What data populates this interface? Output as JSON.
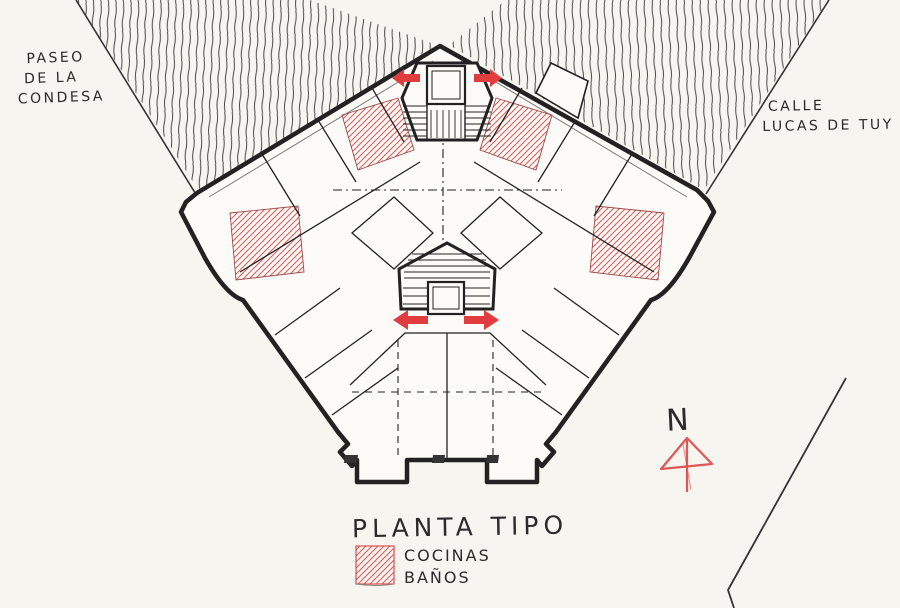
{
  "drawing": {
    "kind": "hand-drawn architectural floor plan sketch",
    "title": "PLANTA TIPO"
  },
  "labels": {
    "street_left": {
      "line1": "PASEO",
      "line2": "DE LA",
      "line3": "CONDESA"
    },
    "street_right": {
      "line1": "CALLE",
      "line2": "LUCAS DE TUY"
    },
    "title": "PLANTA TIPO",
    "legend": {
      "item1": "COCINAS",
      "item2": "BAÑOS"
    },
    "north": "N"
  },
  "legend": {
    "swatch_meaning": "red diagonal hatch marks kitchens and bathrooms"
  },
  "icons": {
    "north_arrow": "north-arrow-icon",
    "entry_arrows": "entry-direction-arrow-icon"
  },
  "colors": {
    "paper": "#f7f5f0",
    "paper2": "#fcfbf7",
    "ink": "#222222",
    "ink_soft": "#555555",
    "red": "#d94f4f",
    "red_arrow": "#e03e3e"
  }
}
